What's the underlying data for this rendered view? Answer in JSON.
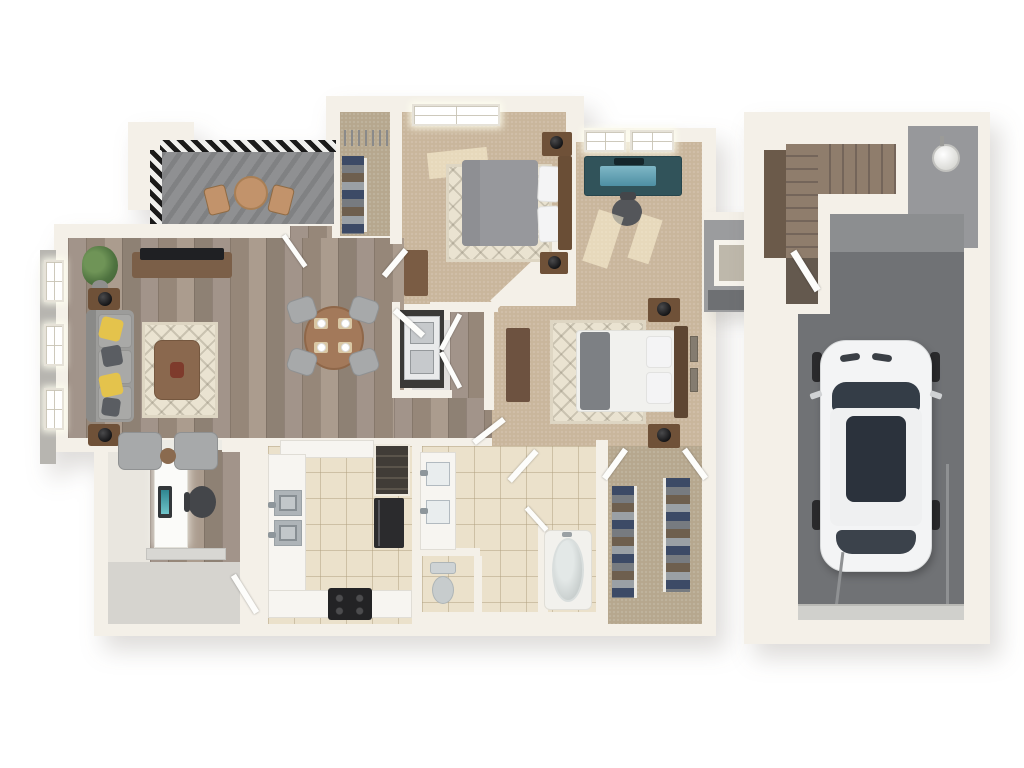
{
  "scene": {
    "type": "3d-floor-plan-render",
    "view": "top-down dollhouse",
    "background": "#ffffff",
    "description": "3D rendered floor plan of a one-bedroom-plus-den style apartment with balcony, two bedrooms, bathroom, walk-in closet and a detached single-car garage with staircase."
  },
  "palette": {
    "wall": "#f4f0e8",
    "wallEdge": "#ded7c9",
    "woodA": "#a2948a",
    "woodB": "#968779",
    "woodC": "#ab9c8e",
    "woodD": "#8e8174",
    "carpet": "#c9b69c",
    "carpetDark": "#b6a78e",
    "tile": "#ebe1cb",
    "balcony": "#8f9092",
    "concrete": "#d6d4cf",
    "garageFloor": "#707275",
    "grayWall": "#8c8e90",
    "railing": "#1a1a1a",
    "sofa": "#9c9c9a",
    "cushion": "#a9a9a7",
    "pillowYellow": "#e4c34c",
    "pillowGray": "#5a5d62",
    "rug": "#eae3d1",
    "woodFurniture": "#7b5f48",
    "darkWood": "#6a4e36",
    "tableWood": "#a3795a",
    "chairGray": "#a7a9aa",
    "duvetGray": "#97989c",
    "duvetWhite": "#f1f1ee",
    "throwGray": "#7d8084",
    "pillowWhite": "#f4f4f5",
    "black": "#232325",
    "stainless": "#c2c7ca",
    "marble": "#f7f5f1",
    "porcelain": "#cbd1d0",
    "tealScreen": "#2f8691",
    "deskTeal": "#31535a",
    "clothesNavy": "#3c4a66",
    "clothesGray": "#777b80",
    "clothesBrown": "#6e5f4e",
    "clothesLight": "#9aa0a5",
    "stairTread": "#8f7d6c",
    "stairRiser": "#74655a",
    "carBody": "#f3f4f5",
    "carGlass": "#343d47",
    "heaterWhite": "#f1f1ef",
    "plantGreen": "#4f7340"
  },
  "rooms": [
    {
      "id": "balcony",
      "name": "Balcony",
      "floor": "concrete"
    },
    {
      "id": "living-room",
      "name": "Living Room",
      "floor": "hardwood"
    },
    {
      "id": "dining-area",
      "name": "Dining Area",
      "floor": "hardwood"
    },
    {
      "id": "bedroom-2",
      "name": "Bedroom 2",
      "floor": "carpet"
    },
    {
      "id": "bedroom-2-closet",
      "name": "Bedroom 2 Closet",
      "floor": "carpet"
    },
    {
      "id": "master-bedroom",
      "name": "Master Bedroom",
      "floor": "carpet"
    },
    {
      "id": "laundry-closet",
      "name": "Laundry Closet",
      "floor": "vinyl"
    },
    {
      "id": "kitchen",
      "name": "Kitchen",
      "floor": "tile"
    },
    {
      "id": "bathroom",
      "name": "Bathroom",
      "floor": "tile"
    },
    {
      "id": "water-closet",
      "name": "Water Closet",
      "floor": "tile"
    },
    {
      "id": "walk-in-closet",
      "name": "Walk-in Closet",
      "floor": "carpet"
    },
    {
      "id": "entry-foyer",
      "name": "Entry Foyer",
      "floor": "concrete"
    },
    {
      "id": "desk-nook",
      "name": "Built-in Desk Nook",
      "floor": "hardwood"
    },
    {
      "id": "hallway",
      "name": "Hallway",
      "floor": "hardwood"
    },
    {
      "id": "stairwell",
      "name": "Garage Stairwell",
      "floor": "wood-stairs"
    },
    {
      "id": "garage",
      "name": "Single-Car Garage",
      "floor": "concrete"
    }
  ],
  "furniture": {
    "balcony": [
      "bistro-table",
      "bistro-chair-left",
      "bistro-chair-right",
      "slatted-railing"
    ],
    "living_room": [
      "sofa",
      "yellow-throw-pillow",
      "yellow-throw-pillow",
      "gray-throw-pillow",
      "gray-throw-pillow",
      "side-table-with-lamp",
      "side-table-with-lamp",
      "tv-console",
      "flat-screen-tv",
      "potted-plant",
      "area-rug",
      "coffee-table",
      "decor-centerpiece",
      "accent-chair",
      "accent-chair",
      "round-side-table",
      "windows-x3"
    ],
    "dining_area": [
      "round-dining-table",
      "dining-chair",
      "dining-chair",
      "dining-chair",
      "dining-chair",
      "place-setting",
      "place-setting",
      "place-setting",
      "place-setting"
    ],
    "bedroom_2": [
      "queen-bed-gray-duvet",
      "headboard",
      "nightstand-with-lamp",
      "nightstand-with-lamp",
      "dresser",
      "area-rug",
      "window",
      "door"
    ],
    "bedroom_2_closet": [
      "hanging-clothes",
      "hanger-rod",
      "empty-hangers"
    ],
    "master_bedroom": [
      "queen-bed-white-duvet",
      "gray-throw-blanket",
      "headboard",
      "nightstand-with-lamp",
      "nightstand-with-lamp",
      "dresser",
      "area-rug",
      "glass-desk-with-monitor",
      "office-chair",
      "wall-art",
      "wall-art",
      "window",
      "window"
    ],
    "laundry_closet": [
      "stacked-washer-dryer",
      "bifold-doors"
    ],
    "kitchen": [
      "upper-counter",
      "pantry-shelves",
      "refrigerator",
      "side-counter",
      "double-basin-sink",
      "bottom-counter",
      "range-stove"
    ],
    "bathroom": [
      "double-vanity",
      "vanity-sink",
      "vanity-sink",
      "bathtub",
      "toilet",
      "doors"
    ],
    "walk_in_closet": [
      "hanging-clothes-left",
      "hanging-clothes-right",
      "double-doors"
    ],
    "entry_foyer": [
      "built-in-desk",
      "monitor",
      "office-chair",
      "wall-shelf",
      "front-door"
    ],
    "garage": [
      "white-suv",
      "l-shaped-staircase",
      "water-heater",
      "garage-door",
      "door-track",
      "door-track"
    ],
    "connector": [
      "breezeway-window-opening"
    ]
  }
}
